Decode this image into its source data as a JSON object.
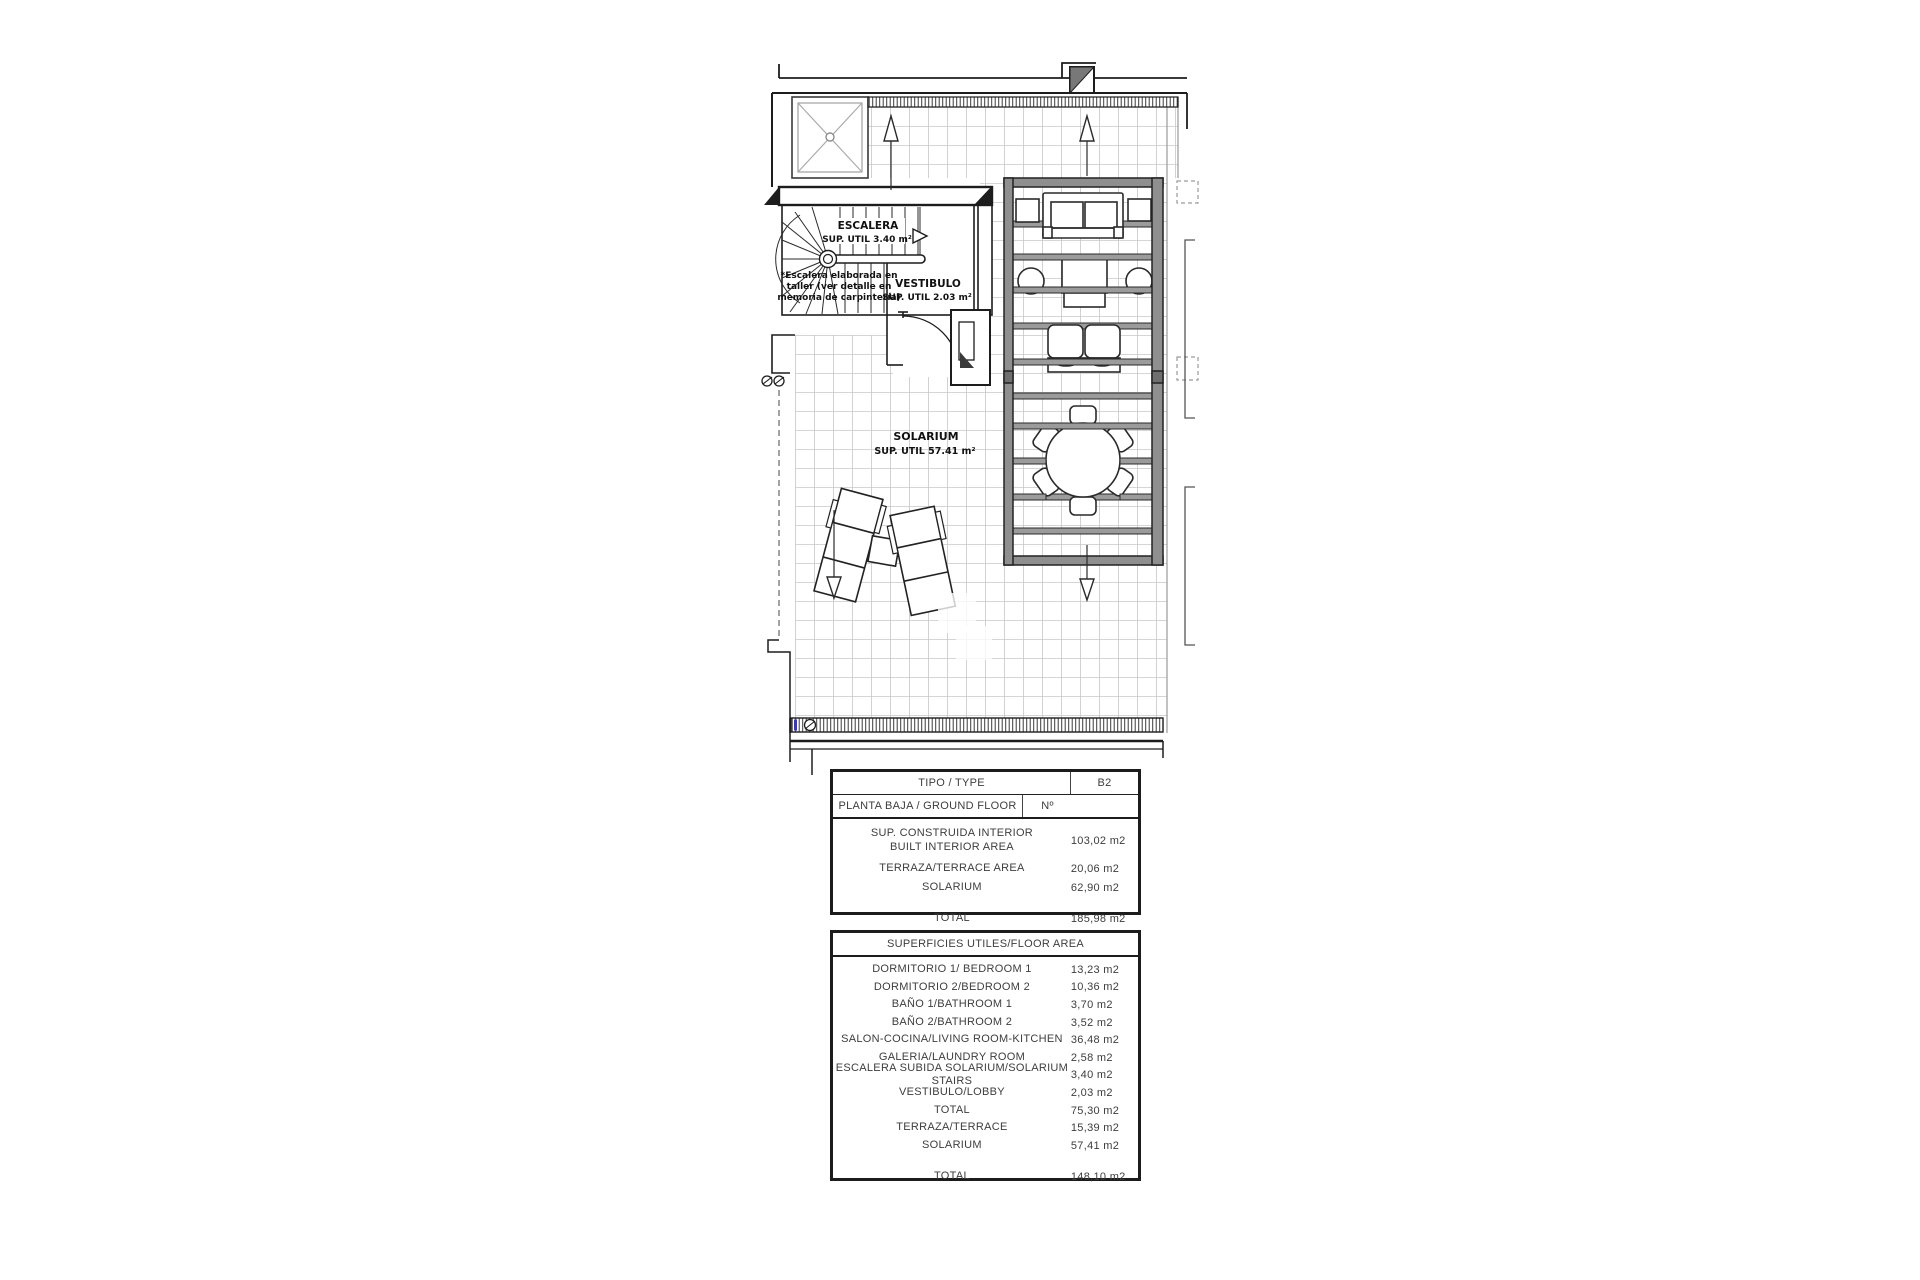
{
  "plan": {
    "escalera_label": "ESCALERA",
    "escalera_area": "SUP. UTIL 3.40 m²",
    "vestibulo_label": "VESTIBULO",
    "vestibulo_area": "SUP. UTIL 2.03 m²",
    "solarium_label": "SOLARIUM",
    "solarium_area": "SUP. UTIL 57.41 m²",
    "note_line1": "*Escalera elaborada en",
    "note_line2": "taller (ver detalle en",
    "note_line3": "memoria de carpintería)"
  },
  "summary_table": {
    "type_label": "TIPO / TYPE",
    "type_value": "B2",
    "floor_label": "PLANTA BAJA / GROUND FLOOR",
    "number_label": "Nº",
    "rows": [
      {
        "label": "SUP. CONSTRUIDA INTERIOR",
        "label2": "BUILT INTERIOR AREA",
        "value": "103,02 m2"
      },
      {
        "label": "TERRAZA/TERRACE AREA",
        "value": "20,06 m2"
      },
      {
        "label": "SOLARIUM",
        "value": "62,90 m2"
      }
    ],
    "total_label": "TOTAL",
    "total_value": "185,98 m2"
  },
  "areas_table": {
    "header": "SUPERFICIES UTILES/FLOOR AREA",
    "rows": [
      {
        "label": "DORMITORIO 1/ BEDROOM 1",
        "value": "13,23 m2"
      },
      {
        "label": "DORMITORIO 2/BEDROOM 2",
        "value": "10,36 m2"
      },
      {
        "label": "BAÑO 1/BATHROOM 1",
        "value": "3,70 m2"
      },
      {
        "label": "BAÑO 2/BATHROOM 2",
        "value": "3,52 m2"
      },
      {
        "label": "SALON-COCINA/LIVING ROOM-KITCHEN",
        "value": "36,48 m2"
      },
      {
        "label": "GALERIA/LAUNDRY ROOM",
        "value": "2,58 m2"
      },
      {
        "label": "ESCALERA SUBIDA SOLARIUM/SOLARIUM STAIRS",
        "value": "3,40 m2"
      },
      {
        "label": "VESTIBULO/LOBBY",
        "value": "2,03 m2"
      },
      {
        "label": "TOTAL",
        "value": "75,30 m2"
      },
      {
        "label": "TERRAZA/TERRACE",
        "value": "15,39 m2"
      },
      {
        "label": "SOLARIUM",
        "value": "57,41 m2"
      }
    ],
    "total_label": "TOTAL",
    "total_value": "148,10 m2"
  }
}
